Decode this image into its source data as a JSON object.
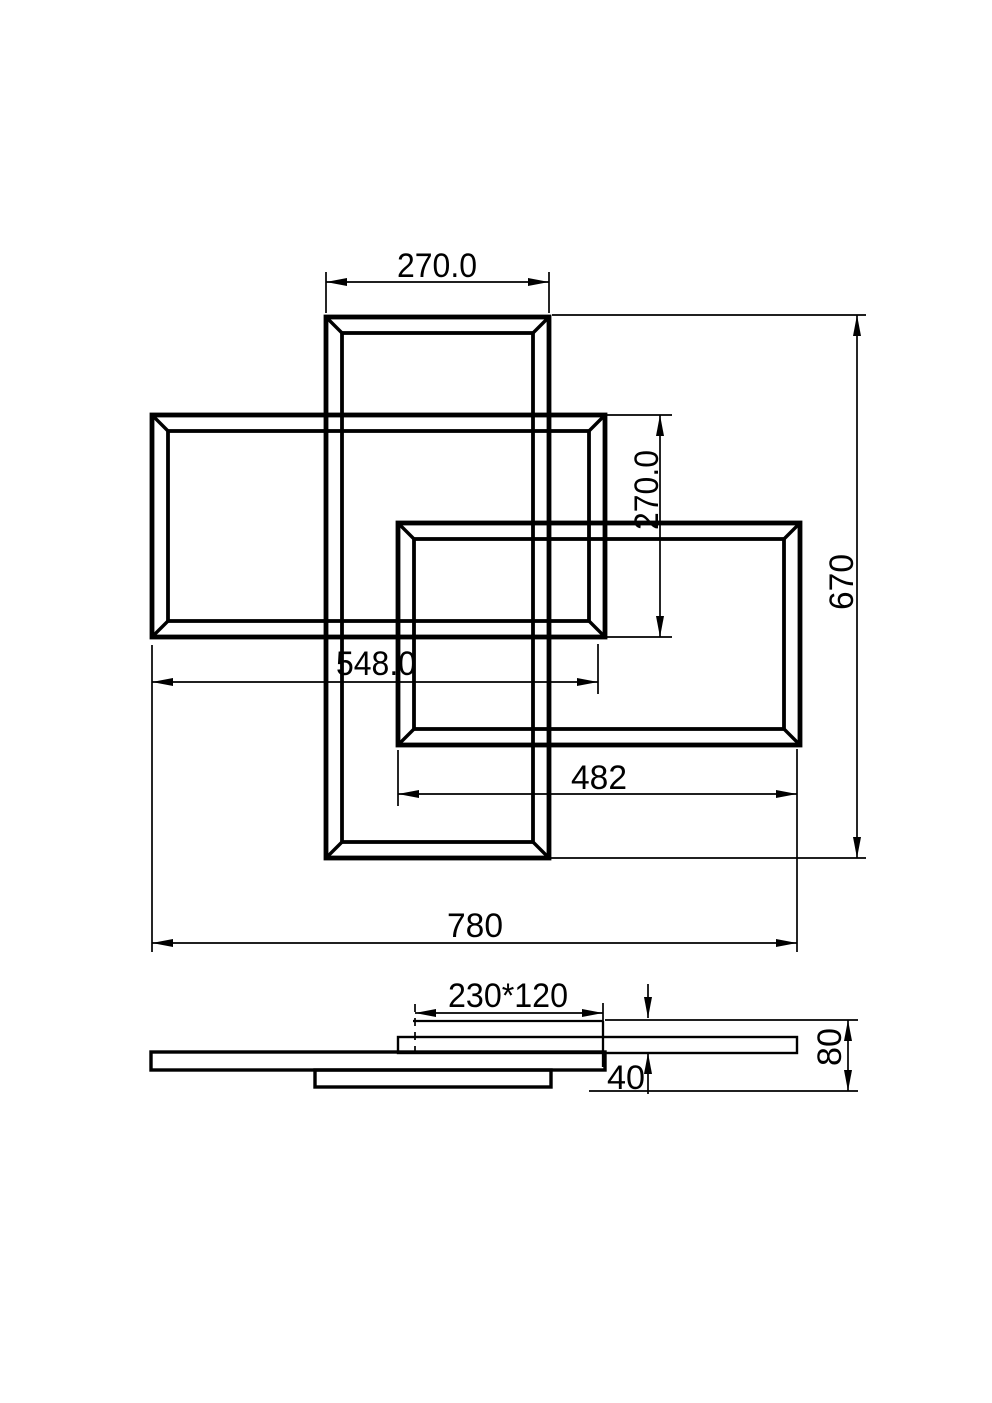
{
  "drawing": {
    "width": 992,
    "height": 1403,
    "background": "#ffffff",
    "ink": "#000000",
    "arrow": {
      "length": 21,
      "half_width": 4
    },
    "frames": [
      {
        "name": "plan-frame-tall-center",
        "outer": [
          326,
          317,
          223,
          541
        ],
        "inset": 16,
        "ow": 4.8,
        "iw": 3.8,
        "bw": 3.4
      },
      {
        "name": "plan-frame-left",
        "outer": [
          152,
          415,
          453,
          222
        ],
        "inset": 16,
        "ow": 4.8,
        "iw": 3.8,
        "bw": 3.4
      },
      {
        "name": "plan-frame-right",
        "outer": [
          398,
          523,
          402,
          222
        ],
        "inset": 16,
        "ow": 4.8,
        "iw": 3.8,
        "bw": 3.4
      }
    ],
    "bars": [
      {
        "name": "side-bar-right",
        "rect": [
          398,
          1037,
          399,
          16
        ],
        "w": 2.4
      },
      {
        "name": "side-bar-main",
        "rect": [
          151,
          1052,
          454,
          18
        ],
        "w": 3.4
      },
      {
        "name": "side-bar-bottom",
        "rect": [
          315,
          1070,
          236,
          17
        ],
        "w": 3.4
      }
    ],
    "lines": [
      {
        "name": "side-canopy-top-line",
        "p": [
          413,
          1021,
          603,
          1021
        ],
        "w": 2.3
      },
      {
        "name": "side-canopy-right-line",
        "p": [
          603,
          1021,
          603,
          1067
        ],
        "w": 2.3
      }
    ],
    "dims": [
      {
        "name": "dim-plan-top-width",
        "label": "270.0",
        "len": 80,
        "rot": 0,
        "lines": [
          [
            326,
            282,
            549,
            282
          ]
        ],
        "arrows": [
          [
            326,
            282,
            "l"
          ],
          [
            549,
            282,
            "r"
          ]
        ],
        "exts": [
          [
            326,
            272,
            326,
            313
          ],
          [
            549,
            272,
            549,
            313
          ]
        ],
        "text": [
          437,
          277
        ]
      },
      {
        "name": "dim-plan-middle-height",
        "label": "270.0",
        "len": 80,
        "rot": -90,
        "lines": [
          [
            660,
            415,
            660,
            637
          ]
        ],
        "arrows": [
          [
            660,
            415,
            "u"
          ],
          [
            660,
            637,
            "d"
          ]
        ],
        "exts": [
          [
            607,
            415,
            672,
            415
          ],
          [
            607,
            637,
            672,
            637
          ]
        ],
        "text": [
          658,
          490
        ]
      },
      {
        "name": "dim-plan-right-height",
        "label": "670",
        "len": 56,
        "rot": -90,
        "lines": [
          [
            857,
            315,
            857,
            858
          ]
        ],
        "arrows": [
          [
            857,
            315,
            "u"
          ],
          [
            857,
            858,
            "d"
          ]
        ],
        "exts": [
          [
            552,
            315,
            866,
            315
          ],
          [
            549,
            858,
            866,
            858
          ]
        ],
        "text": [
          853,
          582
        ]
      },
      {
        "name": "dim-plan-middle-width",
        "label": "548.0",
        "len": 80,
        "rot": 0,
        "lines": [
          [
            152,
            682,
            598,
            682
          ]
        ],
        "arrows": [
          [
            152,
            682,
            "l"
          ],
          [
            598,
            682,
            "r"
          ]
        ],
        "exts": [
          [
            152,
            645,
            152,
            952
          ],
          [
            598,
            644,
            598,
            694
          ]
        ],
        "text": [
          376,
          675
        ]
      },
      {
        "name": "dim-plan-lower-width",
        "label": "482",
        "len": 56,
        "rot": 0,
        "lines": [
          [
            398,
            794,
            797,
            794
          ]
        ],
        "arrows": [
          [
            398,
            794,
            "l"
          ],
          [
            797,
            794,
            "r"
          ]
        ],
        "exts": [
          [
            398,
            750,
            398,
            806
          ],
          [
            797,
            749,
            797,
            952
          ]
        ],
        "text": [
          599,
          789
        ]
      },
      {
        "name": "dim-plan-overall-width",
        "label": "780",
        "len": 56,
        "rot": 0,
        "lines": [
          [
            152,
            943,
            797,
            943
          ]
        ],
        "arrows": [
          [
            152,
            943,
            "l"
          ],
          [
            797,
            943,
            "r"
          ]
        ],
        "exts": [],
        "text": [
          475,
          937
        ]
      },
      {
        "name": "dim-side-canopy",
        "label": "230*120",
        "len": 120,
        "rot": 0,
        "lines": [
          [
            415,
            1013,
            603,
            1013
          ]
        ],
        "arrows": [
          [
            415,
            1013,
            "l"
          ],
          [
            603,
            1013,
            "r"
          ]
        ],
        "exts": [
          [
            603,
            1003,
            603,
            1021
          ],
          [
            415,
            1004,
            415,
            1053,
            1
          ]
        ],
        "text": [
          508,
          1007
        ]
      },
      {
        "name": "dim-side-offset",
        "label": "40",
        "len": 38,
        "rot": 0,
        "lines": [
          [
            648,
            984,
            648,
            1018
          ],
          [
            648,
            1053,
            648,
            1094
          ]
        ],
        "arrows": [
          [
            648,
            1018,
            "d"
          ],
          [
            648,
            1053,
            "u"
          ]
        ],
        "exts": [],
        "text": [
          626,
          1089
        ]
      },
      {
        "name": "dim-side-height",
        "label": "80",
        "len": 38,
        "rot": -90,
        "lines": [
          [
            848,
            1020,
            848,
            1091
          ]
        ],
        "arrows": [
          [
            848,
            1020,
            "u"
          ],
          [
            848,
            1091,
            "d"
          ]
        ],
        "exts": [
          [
            605,
            1020,
            858,
            1020
          ],
          [
            589,
            1091,
            858,
            1091
          ]
        ],
        "text": [
          841,
          1047
        ]
      }
    ]
  }
}
